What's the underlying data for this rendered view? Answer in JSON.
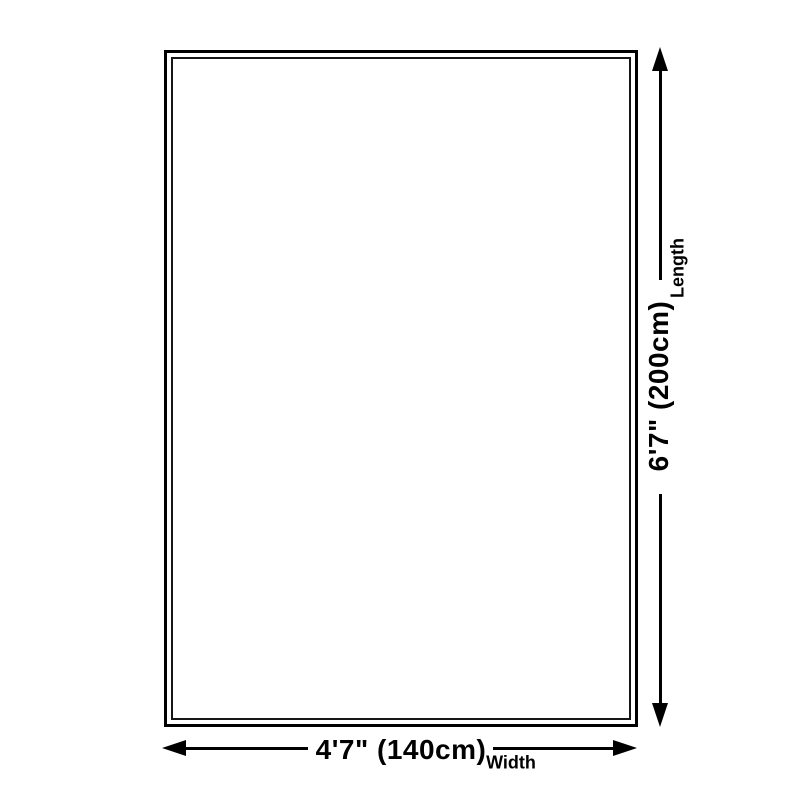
{
  "diagram": {
    "type": "product-size-diagram",
    "length": {
      "value": "6'7\" (200cm)",
      "axis": "Length"
    },
    "width": {
      "value": "4'7\" (140cm)",
      "axis": "Width"
    },
    "colors": {
      "line": "#000000",
      "text": "#000000",
      "background": "#ffffff",
      "outer_border": "#000000",
      "inner_border": "#161616"
    }
  }
}
